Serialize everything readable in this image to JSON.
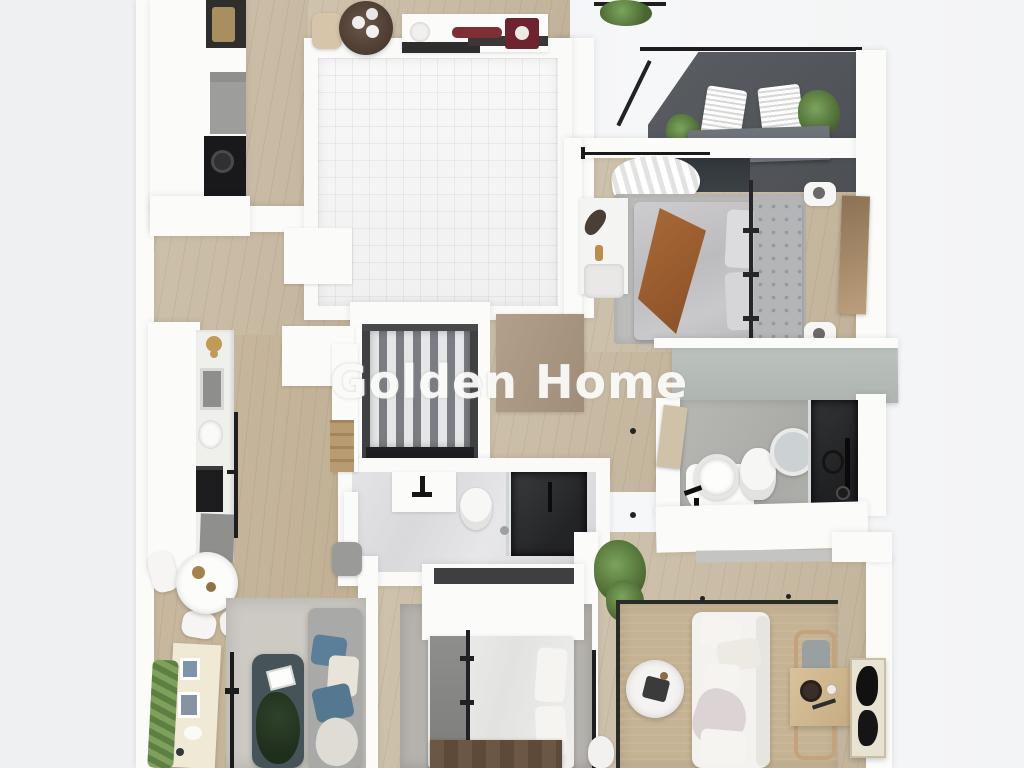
{
  "watermark": {
    "text": "Golden Home"
  },
  "scene": {
    "type": "3d-floor-plan-render",
    "view": "top-down dollhouse",
    "description": "Apartment render: kitchen and tiled utility room at top-left, balcony with two loungers and plants at top-right, master bedroom with gray double bed below the balcony, central staircase, center bathroom with dark shower, second bathroom with round sink and dark shower at right, dining area with round table and gray sofa at bottom-left, second bedroom with white bed at bottom-center, living room with white sofa, round coffee table, desk and wall art at bottom-right"
  },
  "palette": {
    "background": "#f1f2f3",
    "wall": "#fbfbfa",
    "wood_floor": "#c7b8a2",
    "tile_floor": "#f4f4f4",
    "marble_floor": "#dedee0",
    "stone_floor": "#b3b3ae",
    "balcony_floor": "#53575b",
    "rug_beige": "#c6b394",
    "rug_gray": "#b5b2ad",
    "bed_gray": "#c4c4c6",
    "throw_brown": "#9a5e31",
    "sofa_white": "#f3f2ee",
    "sofa_gray": "#a9a9a7",
    "pillow_blue": "#5b7e99",
    "table_teal": "#46545a",
    "plant_green": "#5e7f4e",
    "wood_dark": "#6b5743",
    "shower_dark": "#2c2d2f",
    "wardrobe_gray": "#b7bdb9"
  }
}
